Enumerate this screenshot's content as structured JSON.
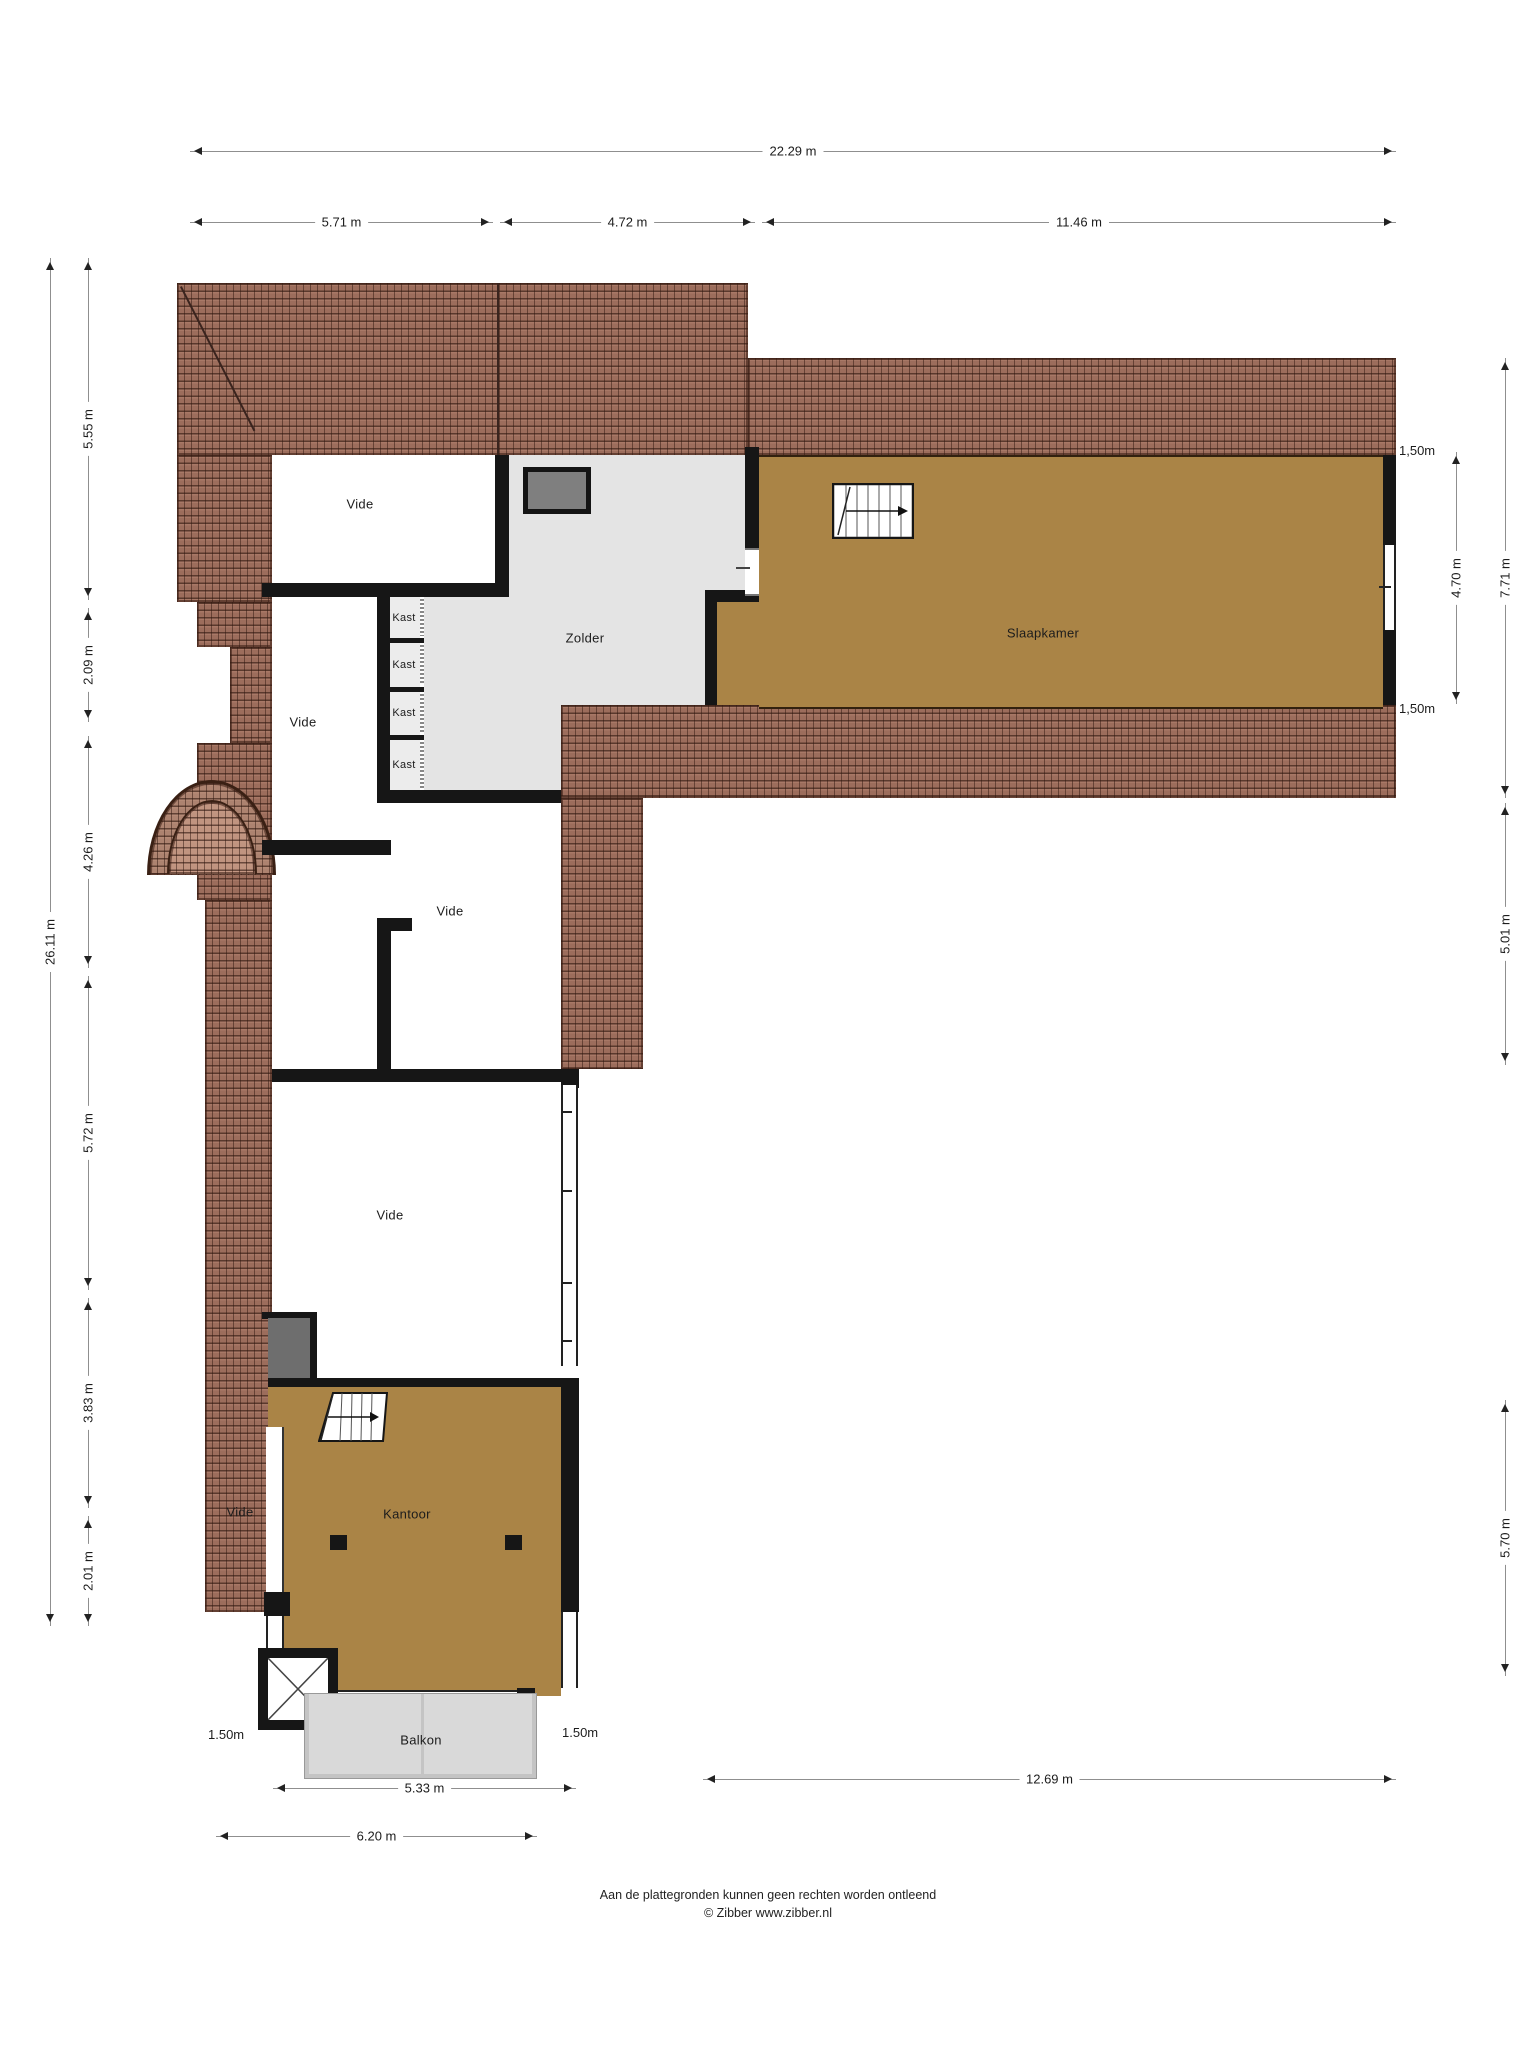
{
  "rooms": {
    "vide": "Vide",
    "zolder": "Zolder",
    "slaapkamer": "Slaapkamer",
    "kast": "Kast",
    "kantoor": "Kantoor",
    "balkon": "Balkon"
  },
  "dimensions": {
    "top_total": "22.29 m",
    "top_left": "5.71 m",
    "top_mid": "4.72 m",
    "top_right": "11.46 m",
    "left_total": "26.11 m",
    "left_1": "5.55 m",
    "left_2": "2.09 m",
    "left_3": "4.26 m",
    "left_4": "5.72 m",
    "left_5": "3.83 m",
    "left_6": "2.01 m",
    "right_total": "7.71 m",
    "right_inner": "4.70 m",
    "right_mid": "5.01 m",
    "right_bottom": "5.70 m",
    "knee_top": "1,50m",
    "knee_bottom": "1,50m",
    "balkon_left": "1.50m",
    "balkon_right": "1.50m",
    "bottom_balkon": "5.33 m",
    "bottom_left": "6.20 m",
    "bottom_right": "12.69 m"
  },
  "footer": {
    "line1": "Aan de plattegronden kunnen geen rechten worden ontleend",
    "line2": "© Zibber www.zibber.nl"
  },
  "colors": {
    "wall": "#161616",
    "roof_base": "#9c6d5c",
    "floor_tan": "#aa8446",
    "floor_gray": "#e4e4e4",
    "floor_kast": "#ececec",
    "balkon_floor": "#d9d9d9",
    "balkon_wall": "#c4c4c4",
    "skylight": "#7f7f7f",
    "graybox": "#6e6e6e",
    "dim_line": "#8f8f8f",
    "text": "#1c1c1c"
  }
}
